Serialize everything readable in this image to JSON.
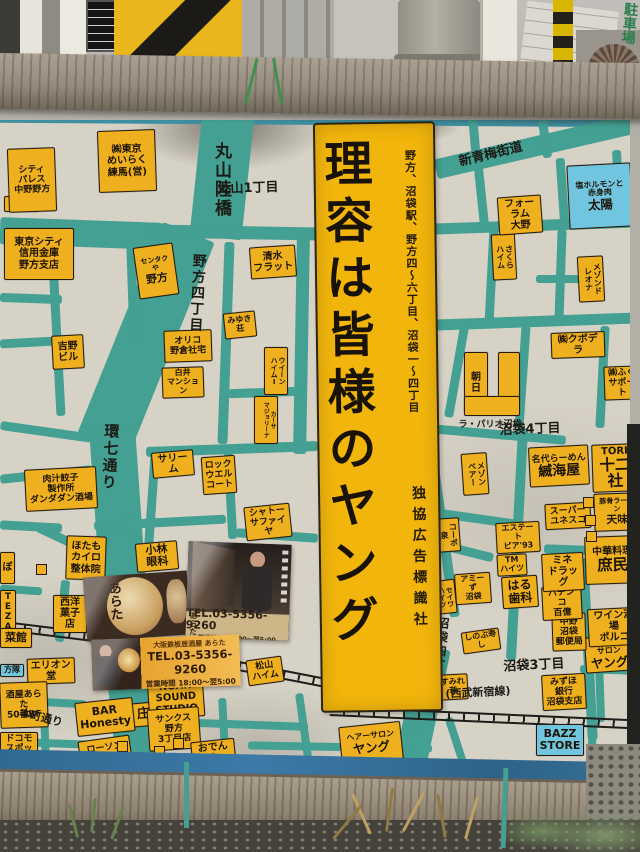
{
  "banner": {
    "title": "理容は皆様のヤング",
    "note": "野方、沼袋駅、野方四～六丁目、沼袋一～四丁目",
    "publisher": "独協広告標識社"
  },
  "photo": {
    "parking_sign": "駐車場"
  },
  "cards": {
    "a": {
      "lantern": "あらた"
    },
    "b": {
      "name": "あらた",
      "tel": "TEL.03-5356-9260",
      "hours": "営業時間 18:00～翌5:00"
    },
    "c": {
      "name": "大阪鉄板居酒屋 あらた",
      "tel": "TEL.03-5356-9260",
      "hours": "営業時間 18:00～翌5:00"
    }
  },
  "palette": {
    "road_teal": "#43a092",
    "label_yellow": "#eeb01f",
    "label_blue": "#72c5de",
    "banner_yellow": "#f1b50c",
    "stripe_blue": "#36719c",
    "rail_black": "#1d1d1a"
  },
  "map": {
    "labels": [
      {
        "t": "野方",
        "x": 4,
        "y": 196,
        "w": 34,
        "h": 16,
        "fs": 9
      },
      {
        "t": "シティ\nパレス\n中野野方",
        "x": 8,
        "y": 148,
        "w": 48,
        "h": 64,
        "fs": 9,
        "r": -2
      },
      {
        "t": "東京シティ\n信用金庫\n野方支店",
        "x": 4,
        "y": 228,
        "w": 70,
        "h": 52,
        "fs": 10
      },
      {
        "t": "㈱東京\nめいらく\n練馬(営)",
        "x": 98,
        "y": 130,
        "w": 58,
        "h": 62,
        "fs": 10,
        "r": -2
      },
      {
        "t": "清水\nフラット",
        "x": 250,
        "y": 246,
        "w": 46,
        "h": 32,
        "fs": 10,
        "r": -4
      },
      {
        "t": "センタクや",
        "b": "野方",
        "x": 136,
        "y": 245,
        "w": 40,
        "h": 52,
        "fs": 7,
        "r": -8
      },
      {
        "t": "みゆき\n荘",
        "x": 224,
        "y": 312,
        "w": 32,
        "h": 26,
        "fs": 8,
        "r": -6
      },
      {
        "t": "オリコ\n野倉社宅",
        "x": 164,
        "y": 330,
        "w": 48,
        "h": 32,
        "fs": 9,
        "r": -2
      },
      {
        "t": "白井\nマンション",
        "x": 162,
        "y": 367,
        "w": 42,
        "h": 28,
        "fs": 8,
        "r": -2
      },
      {
        "t": "吉野\nビル",
        "x": 52,
        "y": 335,
        "w": 32,
        "h": 34,
        "fs": 10,
        "r": -3
      },
      {
        "t": "ウイーン\nハイムⅠ",
        "x": 264,
        "y": 347,
        "w": 24,
        "h": 48,
        "fs": 7,
        "vert": 1
      },
      {
        "t": "カーサ\nマジョリーナ",
        "x": 254,
        "y": 396,
        "w": 24,
        "h": 48,
        "fs": 6,
        "vert": 1
      },
      {
        "t": "サリーム",
        "x": 152,
        "y": 451,
        "w": 42,
        "h": 18,
        "fs": 10,
        "r": -5
      },
      {
        "t": "ロック\nウエル\nコート",
        "x": 202,
        "y": 456,
        "w": 34,
        "h": 38,
        "fs": 9,
        "r": -4
      },
      {
        "t": "シャトー\nサファイヤ",
        "x": 245,
        "y": 505,
        "w": 46,
        "h": 26,
        "fs": 9,
        "r": -6
      },
      {
        "t": "肉汁餃子\n製作所\nダンダダン酒場",
        "x": 25,
        "y": 468,
        "w": 72,
        "h": 42,
        "fs": 9,
        "r": -3
      },
      {
        "t": "ほたも\nカイロ\n整体院",
        "x": 66,
        "y": 536,
        "w": 40,
        "h": 44,
        "fs": 10,
        "r": 2
      },
      {
        "t": "小林\n眼科",
        "x": 136,
        "y": 542,
        "w": 42,
        "h": 26,
        "fs": 11,
        "r": -5
      },
      {
        "t": "西洋\n菓子店",
        "x": 53,
        "y": 595,
        "w": 34,
        "h": 30,
        "fs": 10
      },
      {
        "t": "ぼ",
        "x": 0,
        "y": 552,
        "w": 15,
        "h": 32,
        "fs": 10
      },
      {
        "t": "TE\nZA",
        "x": 0,
        "y": 590,
        "w": 16,
        "h": 28,
        "fs": 9
      },
      {
        "t": "菜館",
        "x": 0,
        "y": 628,
        "w": 32,
        "h": 20,
        "fs": 11
      },
      {
        "t": "方隊",
        "x": 0,
        "y": 664,
        "w": 24,
        "h": 13,
        "fs": 8,
        "type": "b"
      },
      {
        "t": "エリオン堂",
        "x": 27,
        "y": 658,
        "w": 48,
        "h": 24,
        "fs": 10,
        "r": -2
      },
      {
        "t": "酒屋あらた\n50番BF",
        "x": 0,
        "y": 682,
        "w": 48,
        "h": 46,
        "fs": 9,
        "r": -2
      },
      {
        "t": "庄や",
        "x": 128,
        "y": 702,
        "w": 44,
        "h": 24,
        "fs": 13,
        "r": -5
      },
      {
        "t": "ドコモ\nスポット",
        "x": 0,
        "y": 732,
        "w": 38,
        "h": 30,
        "fs": 9
      },
      {
        "t": "BAR\nHonesty",
        "x": 76,
        "y": 700,
        "w": 58,
        "h": 34,
        "fs": 11,
        "r": -6
      },
      {
        "t": "ローソン\n野方\n5丁目店",
        "x": 80,
        "y": 738,
        "w": 52,
        "h": 40,
        "fs": 9,
        "r": -8
      },
      {
        "t": "NOAH\nSOUND\nSTUDIO",
        "x": 148,
        "y": 678,
        "w": 56,
        "h": 40,
        "fs": 10,
        "r": -4
      },
      {
        "t": "サンクス\n野方\n3丁目店",
        "x": 148,
        "y": 708,
        "w": 52,
        "h": 42,
        "fs": 9,
        "r": -4
      },
      {
        "t": "おでんや\nおでん",
        "x": 192,
        "y": 740,
        "w": 44,
        "h": 28,
        "fs": 10,
        "r": -6
      },
      {
        "t": "松山\nハイム",
        "x": 247,
        "y": 658,
        "w": 36,
        "h": 26,
        "fs": 9,
        "r": -8
      },
      {
        "t": "ヘアーサロン",
        "b": "ヤング",
        "x": 340,
        "y": 724,
        "w": 62,
        "h": 38,
        "fs": 8,
        "r": -6
      },
      {
        "t": "BAZZ\nSTORE",
        "x": 536,
        "y": 724,
        "w": 48,
        "h": 32,
        "fs": 11,
        "type": "b"
      },
      {
        "t": "すみれ\n荘",
        "x": 438,
        "y": 674,
        "w": 30,
        "h": 26,
        "fs": 8,
        "r": -3
      },
      {
        "t": "みずほ\n銀行\n沼袋支店",
        "x": 542,
        "y": 674,
        "w": 44,
        "h": 36,
        "fs": 9,
        "r": -3
      },
      {
        "t": "ヘアー\nサロン",
        "b": "ヤング",
        "x": 585,
        "y": 636,
        "w": 48,
        "h": 36,
        "fs": 8,
        "r": -4
      },
      {
        "t": "ワイン酒場\nポルコ",
        "x": 588,
        "y": 608,
        "w": 52,
        "h": 30,
        "fs": 10,
        "r": -3
      },
      {
        "t": "中野\n沼袋\n郵便局",
        "x": 552,
        "y": 613,
        "w": 34,
        "h": 38,
        "fs": 9,
        "r": -2
      },
      {
        "t": "パチンコ\n百億",
        "x": 542,
        "y": 586,
        "w": 40,
        "h": 26,
        "fs": 9,
        "r": -3
      },
      {
        "t": "中華料理",
        "b": "庶民",
        "x": 585,
        "y": 536,
        "w": 55,
        "h": 48,
        "fs": 10,
        "r": -2
      },
      {
        "t": "ミネ\nドラッグ",
        "x": 542,
        "y": 553,
        "w": 42,
        "h": 28,
        "fs": 10,
        "r": -3
      },
      {
        "t": "はる\n歯科",
        "x": 502,
        "y": 576,
        "w": 36,
        "h": 32,
        "fs": 12,
        "r": -4
      },
      {
        "t": "TM\nハイツ",
        "x": 497,
        "y": 554,
        "w": 30,
        "h": 20,
        "fs": 8,
        "r": -3
      },
      {
        "t": "エステート\nピア'93",
        "x": 496,
        "y": 522,
        "w": 44,
        "h": 22,
        "fs": 8,
        "r": -3
      },
      {
        "t": "スーパー\nユネスコ",
        "x": 545,
        "y": 503,
        "w": 46,
        "h": 26,
        "fs": 9,
        "r": -3
      },
      {
        "t": "豚骨ラーメン",
        "b": "天味",
        "x": 594,
        "y": 493,
        "w": 46,
        "h": 38,
        "fs": 7,
        "r": -2
      },
      {
        "t": "TORI",
        "b": "十二社",
        "x": 592,
        "y": 444,
        "w": 46,
        "h": 32,
        "fs": 10,
        "r": -2
      },
      {
        "t": "名代らーめん",
        "b": "縅海屋",
        "x": 529,
        "y": 446,
        "w": 60,
        "h": 40,
        "fs": 9,
        "r": -3
      },
      {
        "t": "メゾン\nベアー",
        "x": 462,
        "y": 453,
        "w": 26,
        "h": 42,
        "fs": 8,
        "vert": 1,
        "r": -4
      },
      {
        "t": "コーポ\n泉",
        "x": 436,
        "y": 518,
        "w": 24,
        "h": 34,
        "fs": 8,
        "vert": 1,
        "r": -4
      },
      {
        "t": "セイワ\nハイツ",
        "x": 432,
        "y": 580,
        "w": 24,
        "h": 34,
        "fs": 7,
        "vert": 1,
        "r": -6
      },
      {
        "t": "アミーず\n沼袋",
        "x": 455,
        "y": 573,
        "w": 36,
        "h": 24,
        "fs": 8,
        "r": -4
      },
      {
        "t": "しのぶ寿し",
        "x": 462,
        "y": 630,
        "w": 38,
        "h": 14,
        "fs": 8,
        "r": -8
      },
      {
        "t": "㈱クボデラ",
        "x": 551,
        "y": 332,
        "w": 54,
        "h": 26,
        "fs": 10,
        "r": -2
      },
      {
        "t": "㈱ふく\nサポート",
        "x": 604,
        "y": 366,
        "w": 36,
        "h": 30,
        "fs": 9,
        "r": -2
      },
      {
        "t": "さくら\nハイム",
        "x": 492,
        "y": 234,
        "w": 24,
        "h": 46,
        "fs": 8,
        "vert": 1,
        "r": -3
      },
      {
        "t": "メゾンド\nレオナ",
        "x": 578,
        "y": 256,
        "w": 26,
        "h": 46,
        "fs": 8,
        "vert": 1,
        "r": -3
      },
      {
        "t": "フォーラム\n大野",
        "x": 498,
        "y": 196,
        "w": 44,
        "h": 32,
        "fs": 10,
        "r": -4
      },
      {
        "t": "塩ホルモンと\n赤身肉",
        "b": "太陽",
        "x": 568,
        "y": 164,
        "w": 64,
        "h": 64,
        "fs": 8,
        "type": "b",
        "r": -3
      },
      {
        "t": "朝日",
        "x": 464,
        "y": 352,
        "w": 24,
        "h": 62,
        "fs": 10
      },
      {
        "t": "",
        "x": 498,
        "y": 352,
        "w": 22,
        "h": 50
      },
      {
        "t": "",
        "x": 464,
        "y": 396,
        "w": 56,
        "h": 20
      },
      {
        "t": "ラ・パリオ沼袋",
        "x": 458,
        "y": 418,
        "w": 64,
        "h": 14,
        "fs": 9,
        "type": "t"
      },
      {
        "t": "丸山1丁目",
        "x": 208,
        "y": 180,
        "w": 80,
        "h": 18,
        "fs": 13,
        "type": "t",
        "r": -2
      },
      {
        "t": "新青梅街道",
        "x": 446,
        "y": 146,
        "w": 90,
        "h": 18,
        "fs": 13,
        "type": "t",
        "r": -14
      },
      {
        "t": "沼袋4丁目",
        "x": 492,
        "y": 422,
        "w": 76,
        "h": 16,
        "fs": 13,
        "type": "t",
        "r": -2
      },
      {
        "t": "沼袋3丁目",
        "x": 496,
        "y": 658,
        "w": 76,
        "h": 16,
        "fs": 13,
        "type": "t",
        "r": -3
      },
      {
        "t": "(西武新宿線)",
        "x": 426,
        "y": 686,
        "w": 104,
        "h": 14,
        "fs": 11,
        "type": "t",
        "r": -3
      },
      {
        "t": "本町通り",
        "x": 8,
        "y": 710,
        "w": 66,
        "h": 16,
        "fs": 11,
        "type": "t",
        "r": 14
      },
      {
        "t": "丸山陸橋",
        "x": 202,
        "y": 124,
        "w": 28,
        "h": 112,
        "fs": 17,
        "type": "vt"
      },
      {
        "t": "野方四丁目",
        "x": 178,
        "y": 246,
        "w": 26,
        "h": 94,
        "fs": 14,
        "type": "vt",
        "r": 3
      },
      {
        "t": "環七通り",
        "x": 92,
        "y": 408,
        "w": 26,
        "h": 98,
        "fs": 15,
        "type": "vt",
        "r": 3
      },
      {
        "t": "沼袋四丁目",
        "x": 422,
        "y": 604,
        "w": 24,
        "h": 94,
        "fs": 12,
        "type": "vt",
        "r": 6
      }
    ],
    "roads": [
      [
        196,
        112,
        52,
        126,
        6
      ],
      [
        118,
        224,
        56,
        228,
        22
      ],
      [
        96,
        428,
        46,
        200,
        -4
      ],
      [
        110,
        618,
        44,
        172,
        -6
      ],
      [
        0,
        220,
        162,
        27,
        2
      ],
      [
        150,
        226,
        172,
        13,
        1
      ],
      [
        433,
        134,
        226,
        20,
        -13
      ],
      [
        470,
        112,
        9,
        52,
        -5
      ],
      [
        540,
        112,
        9,
        46,
        -8
      ],
      [
        432,
        220,
        208,
        11,
        -2
      ],
      [
        477,
        166,
        9,
        62,
        -6
      ],
      [
        558,
        158,
        9,
        70,
        -4
      ],
      [
        614,
        150,
        9,
        78,
        -3
      ],
      [
        487,
        229,
        9,
        94,
        3
      ],
      [
        556,
        229,
        9,
        94,
        2
      ],
      [
        536,
        275,
        46,
        8,
        0
      ],
      [
        430,
        316,
        212,
        11,
        -2
      ],
      [
        452,
        326,
        9,
        92,
        10
      ],
      [
        518,
        326,
        9,
        102,
        4
      ],
      [
        598,
        326,
        9,
        102,
        3
      ],
      [
        430,
        430,
        136,
        9,
        5
      ],
      [
        512,
        428,
        10,
        232,
        3
      ],
      [
        430,
        514,
        92,
        9,
        8
      ],
      [
        544,
        546,
        96,
        9,
        2
      ],
      [
        432,
        546,
        62,
        9,
        14
      ],
      [
        436,
        418,
        10,
        200,
        -8
      ],
      [
        583,
        558,
        10,
        182,
        -3
      ],
      [
        0,
        294,
        62,
        9,
        2
      ],
      [
        52,
        244,
        9,
        172,
        -3
      ],
      [
        0,
        338,
        56,
        9,
        -3
      ],
      [
        128,
        244,
        9,
        100,
        -2
      ],
      [
        221,
        242,
        10,
        202,
        2
      ],
      [
        295,
        238,
        13,
        216,
        1
      ],
      [
        228,
        388,
        72,
        9,
        -2
      ],
      [
        146,
        444,
        172,
        10,
        -2
      ],
      [
        147,
        450,
        9,
        112,
        4
      ],
      [
        0,
        428,
        102,
        9,
        8
      ],
      [
        0,
        470,
        92,
        9,
        -6
      ],
      [
        34,
        538,
        72,
        9,
        25
      ],
      [
        0,
        522,
        62,
        9,
        3
      ],
      [
        94,
        518,
        132,
        9,
        -3
      ],
      [
        226,
        453,
        9,
        86,
        -3
      ],
      [
        236,
        531,
        82,
        9,
        4
      ],
      [
        58,
        580,
        9,
        62,
        6
      ],
      [
        0,
        586,
        42,
        8,
        4
      ],
      [
        0,
        698,
        86,
        8,
        3
      ],
      [
        40,
        658,
        8,
        102,
        -2
      ],
      [
        0,
        740,
        142,
        8,
        2
      ],
      [
        130,
        686,
        8,
        82,
        -4
      ],
      [
        146,
        720,
        162,
        8,
        2
      ],
      [
        220,
        698,
        8,
        70,
        -3
      ],
      [
        248,
        743,
        184,
        8,
        1
      ],
      [
        300,
        693,
        8,
        72,
        -8
      ],
      [
        406,
        646,
        32,
        126,
        12
      ],
      [
        408,
        716,
        8,
        54,
        20
      ],
      [
        453,
        716,
        8,
        56,
        -18
      ],
      [
        588,
        718,
        8,
        52,
        4
      ],
      [
        596,
        658,
        8,
        64,
        -2
      ],
      [
        580,
        666,
        60,
        8,
        2
      ]
    ],
    "rails": [
      [
        -4,
        620,
        196,
        7
      ],
      [
        182,
        650,
        156,
        11
      ],
      [
        330,
        706,
        315,
        2.5
      ]
    ],
    "markers": [
      [
        117,
        741
      ],
      [
        154,
        746
      ],
      [
        173,
        738
      ],
      [
        583,
        497
      ],
      [
        585,
        515
      ],
      [
        586,
        531
      ],
      [
        36,
        564
      ]
    ]
  }
}
